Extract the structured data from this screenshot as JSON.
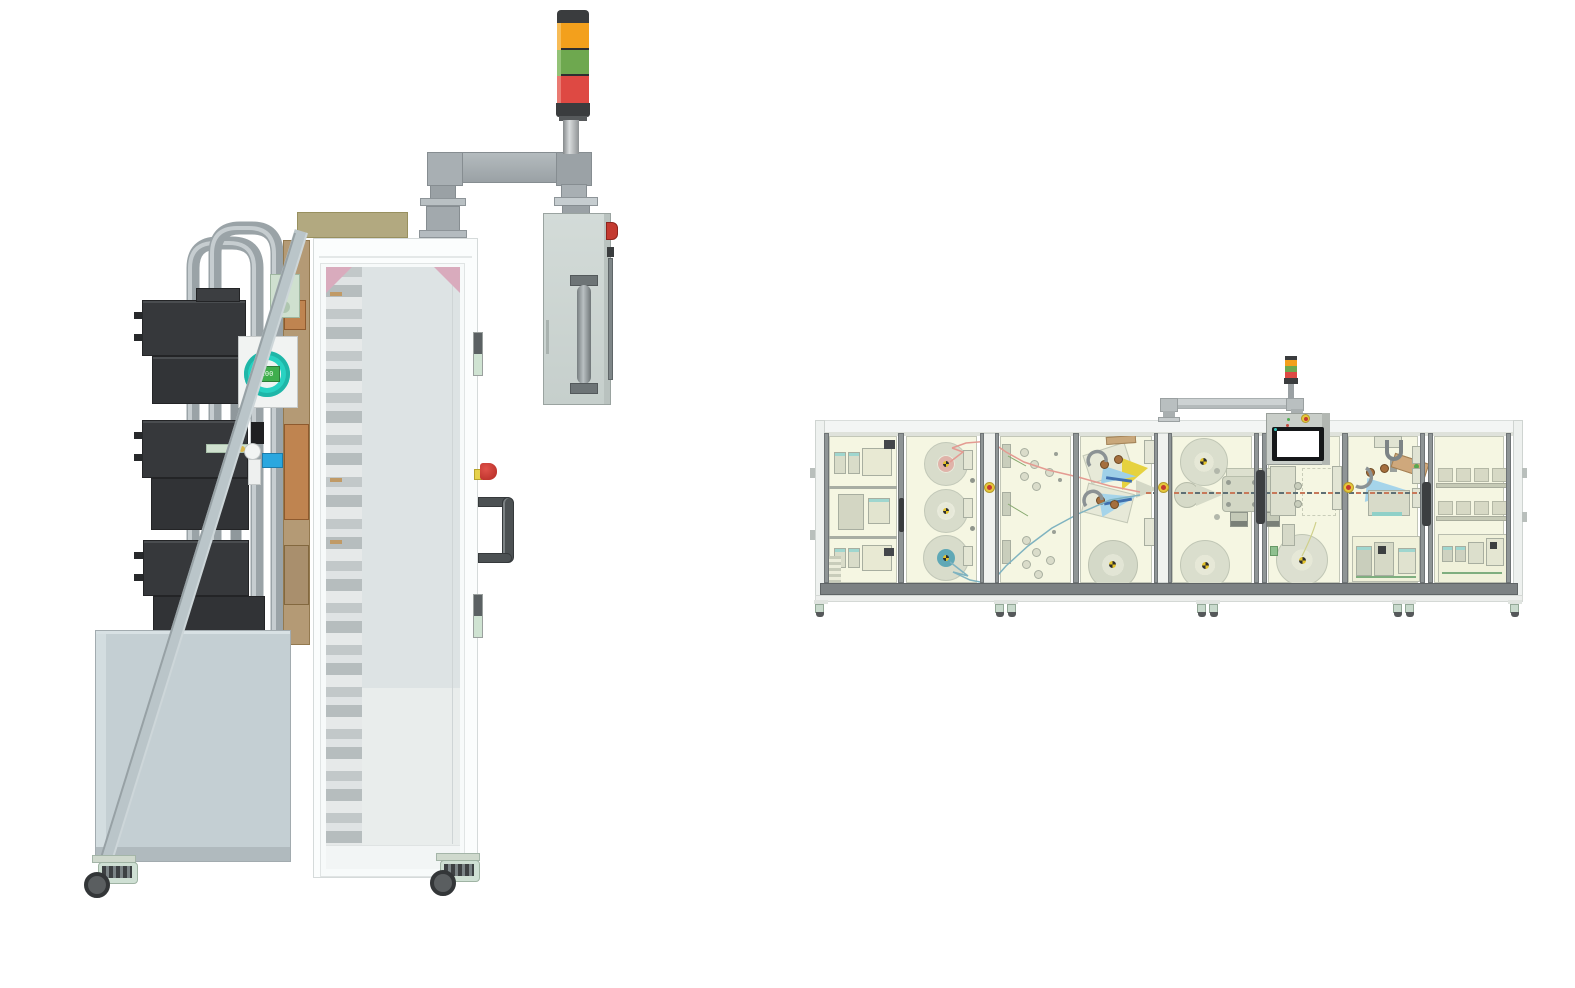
{
  "scene": {
    "background": "#ffffff",
    "machines": [
      "machine-side-view",
      "machine-line-front-view"
    ]
  },
  "palette": {
    "frame_white": "#fbfdfd",
    "base_gray": "#c4cfd3",
    "pipe_gray": "#9aa3a7",
    "motor_dark": "#36383b",
    "tan_panel": "#b49a75",
    "khaki_box": "#b2a980",
    "copper": "#bf8450",
    "teal_gauge_ring": "#28d2c2",
    "gauge_display_green": "#3fae4d",
    "blue_valve_box": "#2aa7df",
    "glass_pane": "#dde3e4",
    "pink_gusset": "#d9abbd",
    "estop_red": "#c43a30",
    "estop_yellow_base": "#e6d24c",
    "tower_orange": "#f3a01c",
    "tower_green": "#6ea84f",
    "tower_red": "#de4943",
    "tower_dark": "#3a3c3e",
    "caster_green": "#cfe0d4",
    "wheel_dark": "#55585a",
    "line_interior_cream": "#f5f6e2",
    "mullion_gray": "#8f9596",
    "equipment_green": "#d3d7c5",
    "reel_hub_pink": "#e0b3a9",
    "reel_hub_teal": "#5fa8b6",
    "thread_pink": "#e49b92",
    "thread_teal": "#7fb3c0",
    "wedge_blue": "#9fd0e8",
    "accent_yellow": "#e6d23f",
    "roller_brown": "#a56f3e",
    "hmi_panel_gray": "#c9cec9",
    "hmi_screen": "#ffffff"
  },
  "left_machine": {
    "label": "process-cabinet-side-view",
    "signal_tower": {
      "segments": [
        "orange",
        "green",
        "red"
      ]
    },
    "flow_gauge": {
      "display_value": "100"
    },
    "pendant_box": {
      "controls": [
        "estop-button",
        "grab-handle"
      ]
    },
    "door": {
      "corner_gussets": "pink",
      "fixtures": [
        "hinge",
        "hinge",
        "estop-button",
        "door-handle"
      ]
    },
    "base": {
      "tank": true,
      "casters": 2
    }
  },
  "right_machine": {
    "label": "production-line-front-view",
    "signal_tower": {
      "segments": [
        "orange",
        "green",
        "red"
      ]
    },
    "hmi": {
      "screen": "blank-white"
    },
    "sections": [
      {
        "name": "electrical-cabinet",
        "shelves": 3
      },
      {
        "name": "unwind-reel-stand",
        "reels": 3,
        "hub_colors": [
          "pink",
          "plain",
          "teal"
        ]
      },
      {
        "name": "dancer-roller-bay"
      },
      {
        "name": "lamination-unit"
      },
      {
        "name": "forming-unit",
        "reels": 2
      },
      {
        "name": "hmi-winder-bay",
        "reels": 1
      },
      {
        "name": "transfer-gripper-bay"
      },
      {
        "name": "shelf-and-control-bay",
        "shelf_rows": 2
      }
    ],
    "post_buttons": 3,
    "caster_feet": 5
  }
}
